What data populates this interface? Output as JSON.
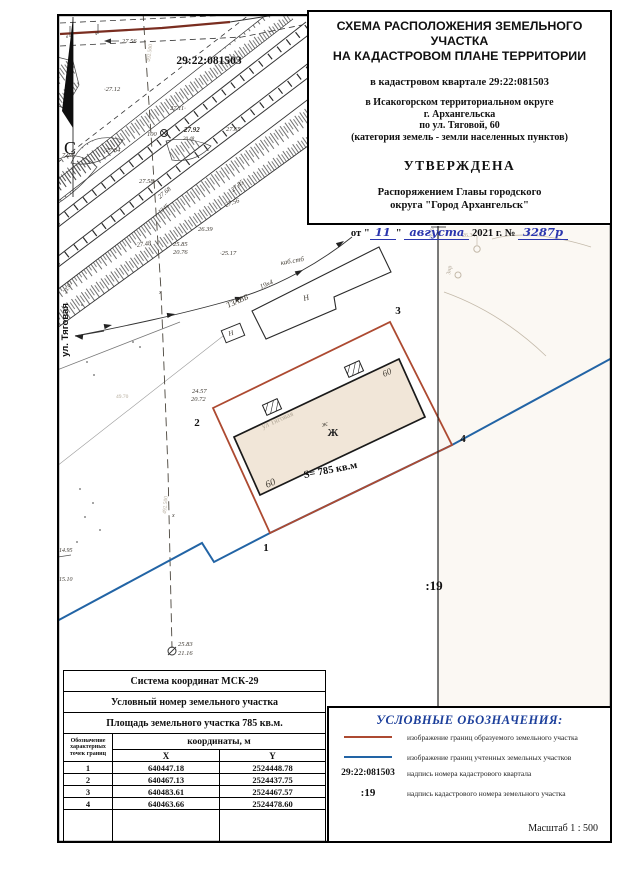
{
  "title_block": {
    "line1": "СХЕМА РАСПОЛОЖЕНИЯ ЗЕМЕЛЬНОГО УЧАСТКА",
    "line2": "НА КАДАСТРОВОМ ПЛАНЕ ТЕРРИТОРИИ",
    "quarter": "в кадастровом квартале 29:22:081503",
    "okrug": "в  Исакогорском территориальном округе",
    "city": "г. Архангельска",
    "street": "по ул. Тяговой, 60",
    "category": "(категория земель - земли населенных пунктов)",
    "approved": "УТВЕРЖДЕНА",
    "order1": "Распоряжением Главы городского",
    "order2": "округа \"Город Архангельск\"",
    "date_open": "от \"",
    "date_day": "11",
    "date_mid": "\"",
    "date_month": "августа",
    "date_year": "2021 г. №",
    "date_num": "3287р"
  },
  "map": {
    "colors": {
      "formed_boundary": "#ad4a31",
      "registered_boundary": "#2264a5",
      "building_fill": "#f1e6d8",
      "top_road": "#7a2d20"
    },
    "labels": [
      {
        "t": "29:22:081503",
        "x": 209,
        "y": 64,
        "s": 11.5,
        "c": "qnum"
      },
      {
        "t": "С",
        "x": 70,
        "y": 154,
        "s": 18,
        "c": "north"
      },
      {
        "t": "ул. Тяговая",
        "x": 68,
        "y": 330,
        "r": -90,
        "s": 9.5,
        "c": "street"
      },
      {
        "t": "27.56",
        "x": 122,
        "y": 43,
        "s": 6.5,
        "c": "ev"
      },
      {
        "t": "·27.12",
        "x": 104,
        "y": 91,
        "s": 6.5,
        "c": "ev"
      },
      {
        "t": "27.11·",
        "x": 170,
        "y": 110,
        "s": 6.5,
        "c": "ev"
      },
      {
        "t": "27.65",
        "x": 226,
        "y": 131,
        "s": 6.5,
        "c": "ev"
      },
      {
        "t": "100",
        "x": 147,
        "y": 136,
        "s": 6.5,
        "c": "ev"
      },
      {
        "t": "27.92",
        "x": 184,
        "y": 132,
        "s": 7,
        "c": "evb"
      },
      {
        "t": "20.48",
        "x": 183,
        "y": 140,
        "s": 5,
        "c": "ev"
      },
      {
        "t": "·27.84",
        "x": 104,
        "y": 152,
        "s": 6.5,
        "c": "ev"
      },
      {
        "t": "7.28·",
        "x": 62,
        "y": 157,
        "s": 6.5,
        "c": "ev"
      },
      {
        "t": "27.58",
        "x": 139,
        "y": 183,
        "s": 6.5,
        "c": "ev"
      },
      {
        "t": "27.56",
        "x": 226,
        "y": 207,
        "r": -20,
        "s": 6.5,
        "c": "ev"
      },
      {
        "t": "27.68",
        "x": 160,
        "y": 199,
        "r": -40,
        "s": 6.5,
        "c": "ev"
      },
      {
        "t": "27.85",
        "x": 233,
        "y": 192,
        "r": -40,
        "s": 6.5,
        "c": "ev"
      },
      {
        "t": "1345",
        "x": 160,
        "y": 214,
        "r": -40,
        "s": 6,
        "c": "ev"
      },
      {
        "t": "27.48",
        "x": 137,
        "y": 247,
        "r": -8,
        "s": 6.5,
        "c": "ev"
      },
      {
        "t": "26.39",
        "x": 198,
        "y": 231,
        "s": 6.5,
        "c": "ev"
      },
      {
        "t": "25.85",
        "x": 173,
        "y": 246,
        "s": 6.5,
        "c": "ev"
      },
      {
        "t": "20.76",
        "x": 173,
        "y": 254,
        "s": 6.5,
        "c": "ev"
      },
      {
        "t": "·25.17",
        "x": 220,
        "y": 255,
        "s": 6.5,
        "c": "ev"
      },
      {
        "t": "21.07",
        "x": 66,
        "y": 294,
        "r": -60,
        "s": 6,
        "c": "ev"
      },
      {
        "t": "в",
        "x": 66,
        "y": 38,
        "s": 5,
        "c": "ev"
      },
      {
        "t": "ч",
        "x": 95,
        "y": 35,
        "s": 5,
        "c": "ev"
      },
      {
        "t": "492.500",
        "x": 150,
        "y": 62,
        "r": -83,
        "s": 5.5,
        "c": "faint"
      },
      {
        "t": "492.500",
        "x": 166,
        "y": 514,
        "r": -85,
        "s": 5.5,
        "c": "faint"
      },
      {
        "t": "х",
        "x": 159,
        "y": 294,
        "s": 6,
        "c": "ev"
      },
      {
        "t": "х",
        "x": 172,
        "y": 517,
        "s": 6,
        "c": "ev"
      },
      {
        "t": "каб.стб",
        "x": 281,
        "y": 265,
        "r": -10,
        "s": 7,
        "c": "hw"
      },
      {
        "t": "ТЗАВБ",
        "x": 228,
        "y": 308,
        "r": -24,
        "s": 8,
        "c": "hw"
      },
      {
        "t": "19х4",
        "x": 261,
        "y": 289,
        "r": -24,
        "s": 7,
        "c": "hw"
      },
      {
        "t": "Н",
        "x": 304,
        "y": 301,
        "r": -15,
        "s": 8,
        "c": "hw"
      },
      {
        "t": "Н",
        "x": 229,
        "y": 336,
        "r": -15,
        "s": 7,
        "c": "hw"
      },
      {
        "t": "24.57",
        "x": 192,
        "y": 393,
        "s": 6.5,
        "c": "ev"
      },
      {
        "t": "20.72",
        "x": 191,
        "y": 401,
        "s": 6.5,
        "c": "ev"
      },
      {
        "t": "2",
        "x": 197,
        "y": 426,
        "s": 11,
        "c": "pt"
      },
      {
        "t": "3",
        "x": 398,
        "y": 314,
        "s": 11,
        "c": "pt"
      },
      {
        "t": "1",
        "x": 266,
        "y": 551,
        "s": 11,
        "c": "pt"
      },
      {
        "t": "4",
        "x": 463,
        "y": 442,
        "s": 11,
        "c": "pt"
      },
      {
        "t": "60",
        "x": 384,
        "y": 377,
        "r": -24,
        "s": 9,
        "c": "hw"
      },
      {
        "t": "60",
        "x": 267,
        "y": 488,
        "r": -24,
        "s": 10,
        "c": "hw"
      },
      {
        "t": "Ж",
        "x": 333,
        "y": 436,
        "s": 11,
        "c": "zh"
      },
      {
        "t": "ж",
        "x": 322,
        "y": 427,
        "r": -15,
        "s": 7,
        "c": "hw"
      },
      {
        "t": "ул Тяговая",
        "x": 263,
        "y": 429,
        "r": -24,
        "s": 7.5,
        "c": "faint"
      },
      {
        "t": "S= 785 кв.м",
        "x": 331,
        "y": 473,
        "r": -11,
        "s": 10.5,
        "c": "area"
      },
      {
        "t": ":19",
        "x": 434,
        "y": 590,
        "s": 13,
        "c": "pt"
      },
      {
        "t": "14.95",
        "x": 59,
        "y": 552,
        "s": 6,
        "c": "ev"
      },
      {
        "t": "15.10",
        "x": 59,
        "y": 581,
        "s": 6,
        "c": "ev"
      },
      {
        "t": "25.83",
        "x": 178,
        "y": 646,
        "s": 6.5,
        "c": "ev"
      },
      {
        "t": "21.16",
        "x": 178,
        "y": 655,
        "s": 6.5,
        "c": "ev"
      },
      {
        "t": "26.34",
        "x": 462,
        "y": 237,
        "s": 6,
        "c": "faint"
      },
      {
        "t": "2616",
        "x": 433,
        "y": 239,
        "r": -85,
        "s": 5.5,
        "c": "faint"
      },
      {
        "t": "Знр",
        "x": 450,
        "y": 275,
        "r": -80,
        "s": 6,
        "c": "faint"
      },
      {
        "t": "49.70",
        "x": 116,
        "y": 398,
        "s": 5.5,
        "c": "faint"
      }
    ]
  },
  "coords_table": {
    "title": "Система координат МСК-29",
    "row2": "Условный номер земельного участка",
    "row3": "Площадь земельного участка  785 кв.м.",
    "col_points_lines": [
      "Обозначение",
      "характерных",
      "точек границ"
    ],
    "col_coords": "координаты, м",
    "col_x": "X",
    "col_y": "Y",
    "rows": [
      {
        "n": "1",
        "x": "640447.18",
        "y": "2524448.78"
      },
      {
        "n": "2",
        "x": "640467.13",
        "y": "2524437.75"
      },
      {
        "n": "3",
        "x": "640483.61",
        "y": "2524467.57"
      },
      {
        "n": "4",
        "x": "640463.66",
        "y": "2524478.60"
      }
    ]
  },
  "legend": {
    "title": "УСЛОВНЫЕ ОБОЗНАЧЕНИЯ:",
    "items": [
      {
        "swatch": "line-red",
        "label": "",
        "desc": "изображение границ образуемого земельного участка"
      },
      {
        "swatch": "line-blue",
        "label": "",
        "desc": "изображение границ учтенных земельных участков"
      },
      {
        "swatch": "text",
        "label": "29:22:081503",
        "desc": "надпись номера кадастрового квартала"
      },
      {
        "swatch": "text",
        "label": ":19",
        "desc": "надпись кадастрового номера земельного участка"
      }
    ],
    "scale": "Масштаб  1 : 500"
  }
}
